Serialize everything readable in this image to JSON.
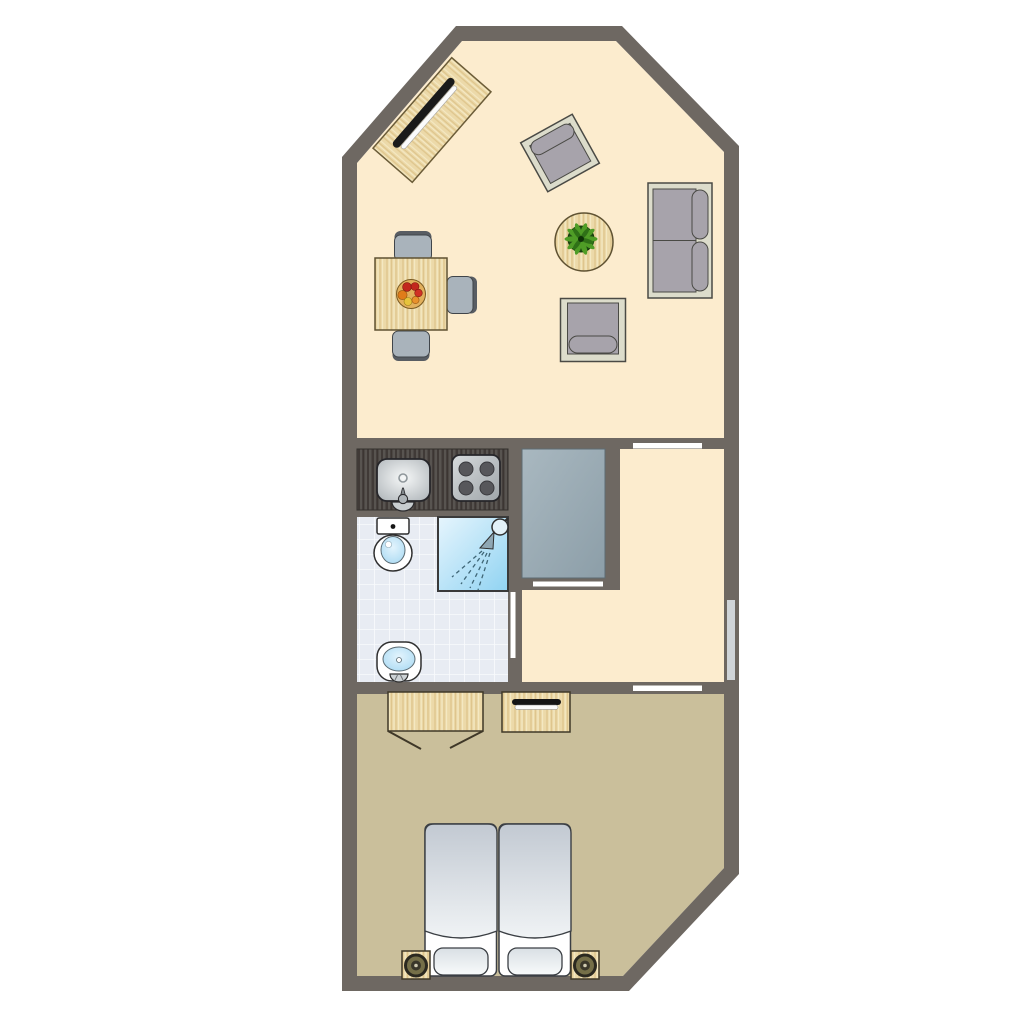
{
  "diagram": {
    "type": "floor-plan",
    "title": "Studio apartment floor plan",
    "rooms": [
      {
        "name": "living-room-with-kitchen",
        "floor_color": "#fcecce"
      },
      {
        "name": "bathroom",
        "floor_color": "#e8ecf3"
      },
      {
        "name": "hallway",
        "floor_color": "#fcecce"
      },
      {
        "name": "built-in-closet",
        "fill_color": "#9aabb4"
      },
      {
        "name": "bedroom",
        "floor_color": "#cabf9b"
      }
    ],
    "colors": {
      "wall": "#6e6862",
      "door_opening": "#ffffff",
      "window": "#cfd4d8",
      "wood": "#ecd9a9",
      "kitchen_counter": "#4c4744",
      "upholstery_frame": "#dcdccb",
      "upholstery_cushion": "#a7a3ab",
      "dining_chair": "#a9b3bb",
      "shower_blue": "#90d3f2",
      "bed_linen": "#eef1f4",
      "plant_green": "#4f9d26",
      "lamp_olive": "#756f48"
    },
    "furniture": {
      "living_room": [
        {
          "name": "tv-sideboard"
        },
        {
          "name": "armchair-tilted"
        },
        {
          "name": "two-seat-sofa"
        },
        {
          "name": "round-table-with-plant"
        },
        {
          "name": "armchair"
        },
        {
          "name": "dining-table-with-fruit-bowl"
        },
        {
          "name": "dining-chair-top"
        },
        {
          "name": "dining-chair-right"
        },
        {
          "name": "dining-chair-bottom"
        }
      ],
      "kitchen": [
        {
          "name": "counter"
        },
        {
          "name": "sink"
        },
        {
          "name": "stove-four-burners"
        }
      ],
      "bathroom": [
        {
          "name": "toilet"
        },
        {
          "name": "shower"
        },
        {
          "name": "washbasin"
        }
      ],
      "hallway": [
        {
          "name": "built-in-closet"
        }
      ],
      "bedroom": [
        {
          "name": "wardrobe-open-doors"
        },
        {
          "name": "dresser-with-tv"
        },
        {
          "name": "single-bed-left"
        },
        {
          "name": "single-bed-right"
        },
        {
          "name": "nightstand-with-lamp-left"
        },
        {
          "name": "nightstand-with-lamp-right"
        }
      ]
    },
    "openings": [
      {
        "name": "door-living-to-hallway"
      },
      {
        "name": "closet-sliding-door"
      },
      {
        "name": "door-hallway-to-bathroom"
      },
      {
        "name": "window-right-wall"
      },
      {
        "name": "door-hallway-to-bedroom"
      }
    ]
  }
}
